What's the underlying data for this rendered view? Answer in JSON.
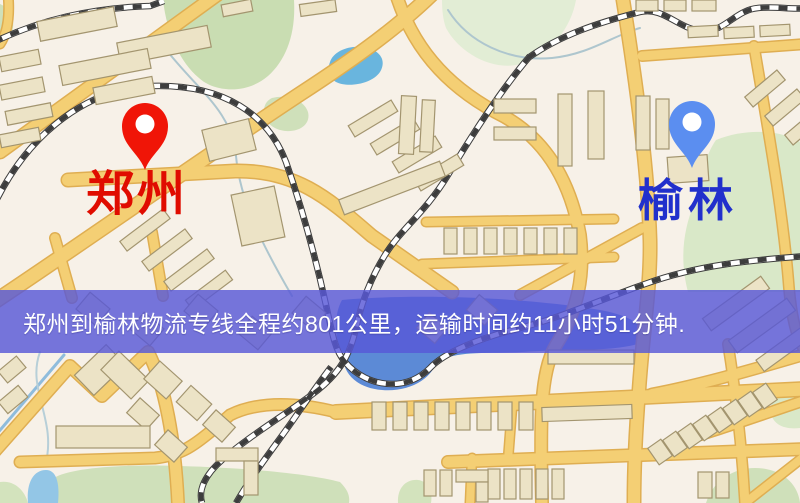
{
  "page": {
    "width": 800,
    "height": 503,
    "kind": "logistics-route-map"
  },
  "banner": {
    "text": "郑州到榆林物流专线全程约801公里，运输时间约11小时51分钟.",
    "bg": "rgba(88,88,215,0.82)",
    "text_color": "#ffffff"
  },
  "route_info": {
    "origin": "郑州",
    "destination": "榆林",
    "distance_km": 801,
    "duration_hours": 11,
    "duration_minutes": 51
  },
  "markers": [
    {
      "id": "origin",
      "label": "郑州",
      "pin_color": "#f01507",
      "label_color": "#e00c00",
      "x": 145,
      "y": 170
    },
    {
      "id": "destination",
      "label": "榆林",
      "pin_color": "#5b8ef0",
      "label_color": "#2130cc",
      "x": 692,
      "y": 168
    }
  ],
  "map": {
    "colors": {
      "bg": "#f7f1e8",
      "road_fill": "#f4cf74",
      "road_casing": "#dfae52",
      "rail_dark": "#3d3d3d",
      "rail_light": "#ffffff",
      "building_fill": "#ece3c6",
      "building_stroke": "#a3956f",
      "park": "#d3e3bd",
      "stream": "#aec6ce"
    },
    "parks": [
      {
        "d": "M 163,0 L 294,0 C 296,34 286,60 268,76 C 246,95 214,92 199,78 C 180,62 167,34 163,0 Z",
        "fill": "#c9ddb2"
      },
      {
        "d": "M 272,98 C 288,94 304,100 308,112 C 311,124 300,132 286,131 C 272,130 262,120 264,109 C 265,103 268,100 272,98 Z",
        "fill": "#cfe0ba"
      },
      {
        "d": "M 716,140 C 748,127 783,131 800,142 L 800,292 L 688,292 C 679,258 684,228 694,204 C 700,178 706,154 716,140 Z",
        "fill": "#d9e8c8"
      },
      {
        "d": "M 0,4 C 10,8 16,20 12,32 C 9,40 0,42 0,42 Z",
        "fill": "#cfe0ba"
      },
      {
        "d": "M 55,503 L 54,478 C 70,468 120,464 180,466 C 250,468 310,474 340,482 C 348,490 350,496 349,503 Z",
        "fill": "#cfe0ba"
      },
      {
        "d": "M 706,503 C 714,477 740,464 766,469 C 786,473 798,486 800,503 Z",
        "fill": "#cfe0ba"
      },
      {
        "d": "M 800,384 C 782,386 770,397 771,412 C 772,424 784,430 800,428 Z",
        "fill": "#d9e8c8"
      },
      {
        "d": "M 398,503 C 397,488 406,479 418,480 C 428,481 433,492 431,503 Z",
        "fill": "#d3e3bd"
      },
      {
        "d": "M 0,503 L 0,482 C 12,480 24,488 28,503 Z",
        "fill": "#d3e3bd"
      },
      {
        "d": "M 442,0 L 576,0 C 571,28 551,53 524,63 C 495,73 460,54 446,28 C 443,20 442,10 442,0 Z",
        "fill": "#e2edd5"
      }
    ],
    "water": [
      {
        "d": "M 330,62 C 334,50 352,44 368,48 C 382,52 386,62 380,72 C 372,84 348,88 336,82 C 328,77 327,70 330,62 Z",
        "fill": "#69b5de"
      },
      {
        "d": "M 342,300 C 420,293 530,298 600,310 C 638,317 650,330 638,344 C 610,352 565,349 522,352 C 486,354 452,350 436,364 C 428,382 406,392 382,390 C 356,388 341,372 344,354 C 333,340 334,314 342,300 Z",
        "fill": "#5c8ad6"
      },
      {
        "d": "M 28,503 C 26,482 34,470 46,470 C 56,470 60,482 58,503 Z",
        "fill": "#93c6e6"
      }
    ],
    "streams": [
      {
        "d": "M 168,52 C 200,92 232,112 236,156 C 240,202 264,248 292,296",
        "w": 2,
        "stroke": "#aec6ce"
      },
      {
        "d": "M 448,10 C 468,42 508,62 552,58 C 590,54 612,36 640,28",
        "w": 2,
        "stroke": "#aec6ce"
      },
      {
        "d": "M -5,436 L 64,355",
        "w": 3,
        "stroke": "#8fbcdc"
      },
      {
        "d": "M 40,352 C 26,390 58,420 45,466",
        "w": 2,
        "stroke": "#b7cfd8"
      }
    ],
    "roads": [
      {
        "d": "M 0,152 L 218,-6",
        "w": 12
      },
      {
        "d": "M -6,302 C 80,245 200,160 300,94 C 360,55 400,25 432,-6",
        "w": 13
      },
      {
        "d": "M 68,180 L 235,171 C 298,170 330,200 372,236 L 452,292",
        "w": 12
      },
      {
        "d": "M -6,452 L 70,366 L 102,396 L 148,352 C 165,385 175,440 178,503",
        "w": 11
      },
      {
        "d": "M 20,462 L 155,458 C 185,455 200,440 215,428 L 230,415 C 260,400 300,403 336,412",
        "w": 10
      },
      {
        "d": "M 336,412 L 806,389",
        "w": 13
      },
      {
        "d": "M 448,462 L 806,449",
        "w": 11
      },
      {
        "d": "M 622,-6 C 636,80 648,170 650,240 C 651,285 643,330 639,390 C 635,440 634,470 634,503",
        "w": 12
      },
      {
        "d": "M 396,-6 C 415,55 455,92 505,117 C 545,140 570,180 580,235 C 585,275 578,310 556,345 C 540,372 540,420 542,503",
        "w": 11
      },
      {
        "d": "M 642,56 L 806,44",
        "w": 9
      },
      {
        "d": "M 754,46 C 768,130 783,210 789,288 C 792,322 798,342 806,352",
        "w": 9
      },
      {
        "d": "M 642,228 L 520,295",
        "w": 9
      },
      {
        "d": "M 426,222 L 614,219",
        "w": 8
      },
      {
        "d": "M 422,264 L 614,257",
        "w": 8
      },
      {
        "d": "M 806,354 C 745,372 695,386 652,394",
        "w": 10
      },
      {
        "d": "M 806,400 C 758,416 714,432 670,444",
        "w": 9
      },
      {
        "d": "M 728,344 C 737,400 742,450 745,503",
        "w": 9
      },
      {
        "d": "M 472,458 L 470,503",
        "w": 8
      },
      {
        "d": "M 512,408 L 508,460",
        "w": 8
      },
      {
        "d": "M 8,-6 C 10,15 8,32 0,44",
        "w": 8
      },
      {
        "d": "M 152,232 L 163,296",
        "w": 9
      },
      {
        "d": "M 55,238 L 72,298",
        "w": 9
      },
      {
        "d": "M 745,503 L 806,455",
        "w": 8
      }
    ],
    "railways": [
      {
        "d": "M -6,205 C 30,130 90,88 152,86 C 225,84 268,115 286,162 C 302,208 315,255 326,305 C 333,338 336,352 345,362 C 355,374 372,384 392,384 C 410,384 422,376 430,368 C 445,352 480,338 520,328 C 560,318 600,300 645,284 C 700,264 755,260 806,256"
      },
      {
        "d": "M 528,58 C 560,35 600,22 640,12 C 665,6 680,32 706,31 C 726,30 736,10 758,8 C 776,6 792,10 806,8"
      },
      {
        "d": "M 530,56 C 505,85 475,130 448,175 C 425,213 400,230 385,255 C 372,276 362,300 356,328 C 350,355 340,372 318,390 C 290,412 250,435 222,460 C 205,475 198,490 202,503"
      },
      {
        "d": "M 236,503 C 255,470 280,440 300,410 C 310,396 321,380 331,367"
      },
      {
        "d": "M -6,42 C 40,20 90,8 150,6 L 164,1"
      }
    ],
    "buildings": [
      [
        38,
        14,
        78,
        20,
        -11
      ],
      [
        118,
        34,
        92,
        22,
        -11
      ],
      [
        60,
        57,
        90,
        20,
        -11
      ],
      [
        94,
        82,
        60,
        17,
        -11
      ],
      [
        0,
        53,
        40,
        15,
        -11
      ],
      [
        0,
        81,
        44,
        15,
        -11
      ],
      [
        6,
        107,
        46,
        14,
        -11
      ],
      [
        0,
        131,
        40,
        13,
        -11
      ],
      [
        205,
        124,
        48,
        32,
        -14
      ],
      [
        222,
        2,
        30,
        12,
        -11
      ],
      [
        300,
        2,
        36,
        12,
        -8
      ],
      [
        118,
        224,
        54,
        12,
        -37
      ],
      [
        140,
        244,
        54,
        12,
        -37
      ],
      [
        162,
        264,
        54,
        12,
        -37
      ],
      [
        184,
        284,
        50,
        12,
        -37
      ],
      [
        348,
        112,
        50,
        13,
        -31
      ],
      [
        370,
        130,
        50,
        13,
        -31
      ],
      [
        392,
        148,
        50,
        13,
        -31
      ],
      [
        414,
        166,
        50,
        13,
        -31
      ],
      [
        338,
        180,
        108,
        16,
        -21
      ],
      [
        236,
        190,
        44,
        52,
        -12
      ],
      [
        400,
        96,
        15,
        58,
        3
      ],
      [
        421,
        100,
        13,
        52,
        3
      ],
      [
        494,
        99,
        42,
        14,
        0
      ],
      [
        494,
        127,
        42,
        13,
        0
      ],
      [
        558,
        94,
        14,
        72,
        0
      ],
      [
        588,
        91,
        16,
        68,
        0
      ],
      [
        444,
        228,
        13,
        26,
        0
      ],
      [
        464,
        228,
        13,
        26,
        0
      ],
      [
        484,
        228,
        13,
        26,
        0
      ],
      [
        504,
        228,
        13,
        26,
        0
      ],
      [
        524,
        228,
        13,
        26,
        0
      ],
      [
        544,
        228,
        13,
        26,
        0
      ],
      [
        564,
        228,
        13,
        26,
        0
      ],
      [
        636,
        96,
        14,
        54,
        0
      ],
      [
        656,
        99,
        13,
        50,
        0
      ],
      [
        668,
        156,
        40,
        26,
        -4
      ],
      [
        744,
        82,
        42,
        13,
        -40
      ],
      [
        764,
        101,
        42,
        13,
        -40
      ],
      [
        784,
        120,
        42,
        13,
        -40
      ],
      [
        636,
        0,
        22,
        11,
        0
      ],
      [
        664,
        0,
        22,
        11,
        0
      ],
      [
        692,
        0,
        24,
        11,
        0
      ],
      [
        688,
        26,
        30,
        11,
        -3
      ],
      [
        724,
        27,
        30,
        11,
        -3
      ],
      [
        760,
        25,
        30,
        11,
        -3
      ],
      [
        80,
        298,
        26,
        22,
        40
      ],
      [
        134,
        318,
        26,
        22,
        40
      ],
      [
        188,
        300,
        26,
        22,
        40
      ],
      [
        242,
        322,
        26,
        22,
        40
      ],
      [
        296,
        302,
        26,
        22,
        40
      ],
      [
        420,
        318,
        24,
        20,
        40
      ],
      [
        470,
        300,
        24,
        20,
        40
      ],
      [
        700,
        296,
        72,
        15,
        -36
      ],
      [
        726,
        318,
        72,
        15,
        -36
      ],
      [
        754,
        340,
        64,
        14,
        -36
      ],
      [
        78,
        356,
        44,
        28,
        -44
      ],
      [
        104,
        362,
        42,
        26,
        44
      ],
      [
        148,
        368,
        30,
        24,
        42
      ],
      [
        180,
        392,
        28,
        22,
        42
      ],
      [
        206,
        416,
        26,
        20,
        42
      ],
      [
        130,
        404,
        26,
        20,
        42
      ],
      [
        158,
        436,
        26,
        20,
        42
      ],
      [
        56,
        426,
        94,
        22,
        0
      ],
      [
        0,
        362,
        24,
        15,
        -40
      ],
      [
        0,
        392,
        26,
        15,
        -40
      ],
      [
        216,
        448,
        42,
        13,
        0
      ],
      [
        244,
        461,
        14,
        34,
        0
      ],
      [
        548,
        350,
        86,
        14,
        0
      ],
      [
        372,
        402,
        14,
        28,
        0
      ],
      [
        393,
        402,
        14,
        28,
        0
      ],
      [
        414,
        402,
        14,
        28,
        0
      ],
      [
        435,
        402,
        14,
        28,
        0
      ],
      [
        456,
        402,
        14,
        28,
        0
      ],
      [
        477,
        402,
        14,
        28,
        0
      ],
      [
        498,
        402,
        14,
        28,
        0
      ],
      [
        519,
        402,
        14,
        28,
        0
      ],
      [
        542,
        406,
        90,
        14,
        -2
      ],
      [
        488,
        469,
        12,
        30,
        0
      ],
      [
        504,
        469,
        12,
        30,
        0
      ],
      [
        520,
        469,
        12,
        30,
        0
      ],
      [
        536,
        469,
        12,
        30,
        0
      ],
      [
        552,
        469,
        12,
        30,
        0
      ],
      [
        424,
        470,
        12,
        26,
        0
      ],
      [
        440,
        470,
        12,
        26,
        0
      ],
      [
        456,
        470,
        32,
        12,
        0
      ],
      [
        476,
        482,
        12,
        20,
        0
      ],
      [
        698,
        472,
        14,
        26,
        0
      ],
      [
        716,
        472,
        13,
        26,
        0
      ],
      [
        652,
        442,
        16,
        20,
        -35
      ],
      [
        667,
        434,
        16,
        20,
        -35
      ],
      [
        682,
        426,
        16,
        20,
        -35
      ],
      [
        697,
        418,
        16,
        20,
        -35
      ],
      [
        712,
        410,
        16,
        20,
        -35
      ],
      [
        727,
        402,
        16,
        20,
        -35
      ],
      [
        742,
        394,
        16,
        20,
        -35
      ],
      [
        757,
        386,
        16,
        20,
        -35
      ]
    ]
  }
}
